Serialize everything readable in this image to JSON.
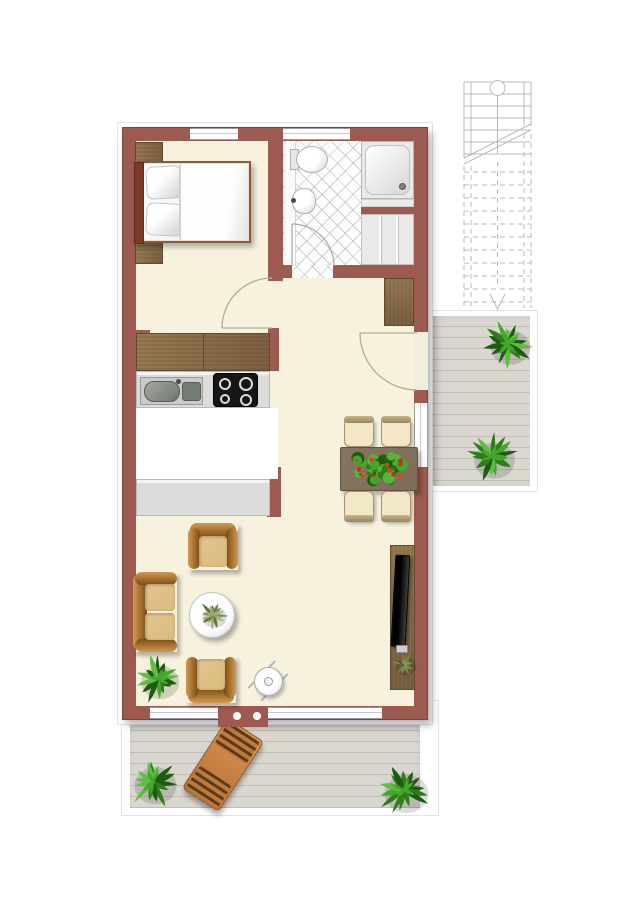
{
  "document": {
    "kind": "apartment-floor-plan",
    "orientation": "portrait",
    "visible_text": []
  },
  "colors": {
    "background": "#ffffff",
    "wall": "#9d5a50",
    "wall_edge": "#7b443b",
    "floor": "#f6f2de",
    "bath_floor": "#fdfdfd",
    "kitchen_tile_light": "#f8f1c6",
    "kitchen_tile_mid": "#f3e6a8",
    "kitchen_tile_dark": "#ecd78c",
    "counter": "#dcdcdc",
    "wood": "#8a6e4b",
    "wood_dark": "#5f4a30",
    "deck": "#dad7d1",
    "deck_line": "#c2beb5",
    "leather_light": "#d09a52",
    "leather_dark": "#7c4c12",
    "cushion": "#daba7e",
    "chair_seat": "#f2e8c8",
    "chair_frame": "#a8926a",
    "table_brown": "#7d6c57",
    "headboard": "#7c3a2a",
    "lounger": "#cd8542",
    "lounger_slat": "#5a3a1c",
    "plant_green_1": "#2e7d19",
    "plant_green_2": "#46a52c",
    "plant_green_3": "#1f5c10",
    "flower_red": "#c03018",
    "tv_black": "#161616",
    "stairs_line": "#b9b9b9",
    "door_arc": "#b3ab9d"
  },
  "rooms": [
    {
      "id": "bedroom",
      "furniture": [
        "double-bed",
        "nightstand-top",
        "nightstand-bottom",
        "wardrobe-row"
      ]
    },
    {
      "id": "bathroom",
      "furniture": [
        "toilet",
        "washbasin",
        "shower",
        "utility-closet"
      ]
    },
    {
      "id": "hall",
      "furniture": [
        "hall-closet",
        "entrance-door"
      ]
    },
    {
      "id": "kitchen",
      "furniture": [
        "counter-with-sink",
        "cooktop",
        "lower-counter",
        "tiled-floor"
      ]
    },
    {
      "id": "dining-area",
      "furniture": [
        "dining-table",
        "dining-chair-1",
        "dining-chair-2",
        "dining-chair-3",
        "dining-chair-4",
        "flower-planter"
      ]
    },
    {
      "id": "living-area",
      "furniture": [
        "sofa",
        "armchair-top",
        "armchair-bottom",
        "coffee-table",
        "side-stool",
        "tv-lowboard",
        "tv",
        "potted-plant"
      ]
    },
    {
      "id": "entrance-balcony",
      "furniture": [
        "staircase",
        "wood-deck",
        "potted-plant",
        "potted-plant"
      ]
    },
    {
      "id": "terrace",
      "furniture": [
        "wood-deck",
        "sun-lounger",
        "potted-plant",
        "potted-plant"
      ]
    }
  ],
  "doors": [
    "bedroom-door",
    "bathroom-door",
    "entrance-door"
  ],
  "windows": [
    "bedroom-top-window",
    "bathroom-top-window",
    "dining-side-window",
    "terrace-window-left",
    "terrace-window-right"
  ]
}
